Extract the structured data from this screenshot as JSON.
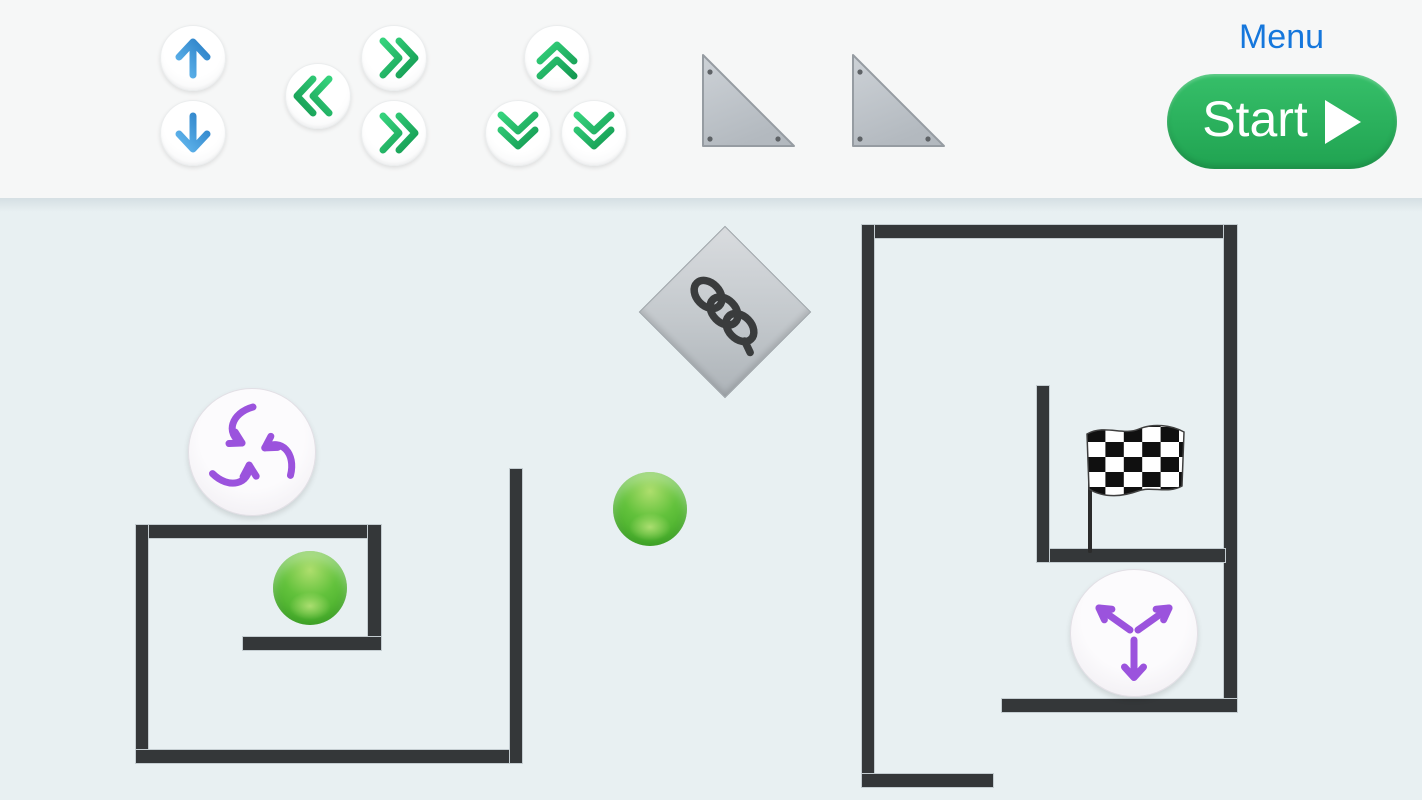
{
  "header": {
    "background_color": "#f6f7f7",
    "menu_label": "Menu",
    "menu_color": "#1577dc",
    "start_button": {
      "label": "Start",
      "icon": "play-icon",
      "background_color": "#2ab45c",
      "text_color": "#ffffff"
    },
    "toolbar_buttons": [
      {
        "name": "move-up-button",
        "icon": "arrow-up-icon",
        "color": "#3c99dc"
      },
      {
        "name": "move-down-button",
        "icon": "arrow-down-icon",
        "color": "#3c99dc"
      },
      {
        "name": "dash-left-button",
        "icon": "double-chevron-left-icon",
        "color": "#21ab60"
      },
      {
        "name": "dash-right-button-top",
        "icon": "double-chevron-right-icon",
        "color": "#21ab60"
      },
      {
        "name": "dash-right-button-bottom",
        "icon": "double-chevron-right-icon",
        "color": "#21ab60"
      },
      {
        "name": "dash-up-button",
        "icon": "double-chevron-up-icon",
        "color": "#21ab60"
      },
      {
        "name": "dash-down-button-left",
        "icon": "double-chevron-down-icon",
        "color": "#21ab60"
      },
      {
        "name": "dash-down-button-right",
        "icon": "double-chevron-down-icon",
        "color": "#21ab60"
      }
    ],
    "shape_palette": [
      {
        "name": "ramp-triangle-left",
        "icon": "right-triangle-icon",
        "color": "#c3c9cf"
      },
      {
        "name": "ramp-triangle-right",
        "icon": "right-triangle-icon",
        "color": "#c3c9cf"
      }
    ]
  },
  "scene": {
    "background_color": "#e8f0f2",
    "wall_color": "#343739",
    "walls": [
      {
        "name": "left-box-top-wall",
        "x": 136,
        "y": 525,
        "w": 245,
        "h": 13
      },
      {
        "name": "left-box-left-wall",
        "x": 136,
        "y": 525,
        "w": 12,
        "h": 238
      },
      {
        "name": "left-box-bottom-wall",
        "x": 136,
        "y": 750,
        "w": 386,
        "h": 13
      },
      {
        "name": "left-box-right-wall",
        "x": 368,
        "y": 525,
        "w": 13,
        "h": 125
      },
      {
        "name": "left-shelf-wall",
        "x": 243,
        "y": 637,
        "w": 138,
        "h": 13
      },
      {
        "name": "left-tall-wall",
        "x": 510,
        "y": 469,
        "w": 12,
        "h": 294
      },
      {
        "name": "right-top-wall",
        "x": 862,
        "y": 225,
        "w": 374,
        "h": 13
      },
      {
        "name": "right-left-wall",
        "x": 862,
        "y": 225,
        "w": 12,
        "h": 562
      },
      {
        "name": "right-bottom-wall",
        "x": 862,
        "y": 774,
        "w": 131,
        "h": 13
      },
      {
        "name": "right-right-wall",
        "x": 1224,
        "y": 225,
        "w": 13,
        "h": 487
      },
      {
        "name": "right-lower-wall",
        "x": 1002,
        "y": 699,
        "w": 235,
        "h": 13
      },
      {
        "name": "right-mid-wall",
        "x": 1037,
        "y": 549,
        "w": 188,
        "h": 13
      },
      {
        "name": "right-inner-wall",
        "x": 1037,
        "y": 386,
        "w": 12,
        "h": 176
      }
    ],
    "objects": [
      {
        "name": "spring-block",
        "icon": "spring-coil-icon",
        "shape": "diamond",
        "color": "#c3c8cc"
      },
      {
        "name": "attract-field",
        "icon": "arrows-inward-icon",
        "color": "#9b53dd"
      },
      {
        "name": "repel-field",
        "icon": "arrows-outward-icon",
        "color": "#9b53dd"
      },
      {
        "name": "green-ball-boxed",
        "color": "#56b93a"
      },
      {
        "name": "green-ball-free",
        "color": "#56b93a"
      },
      {
        "name": "finish-flag",
        "icon": "checkered-flag-icon",
        "colors": [
          "#101010",
          "#ffffff"
        ]
      }
    ]
  }
}
